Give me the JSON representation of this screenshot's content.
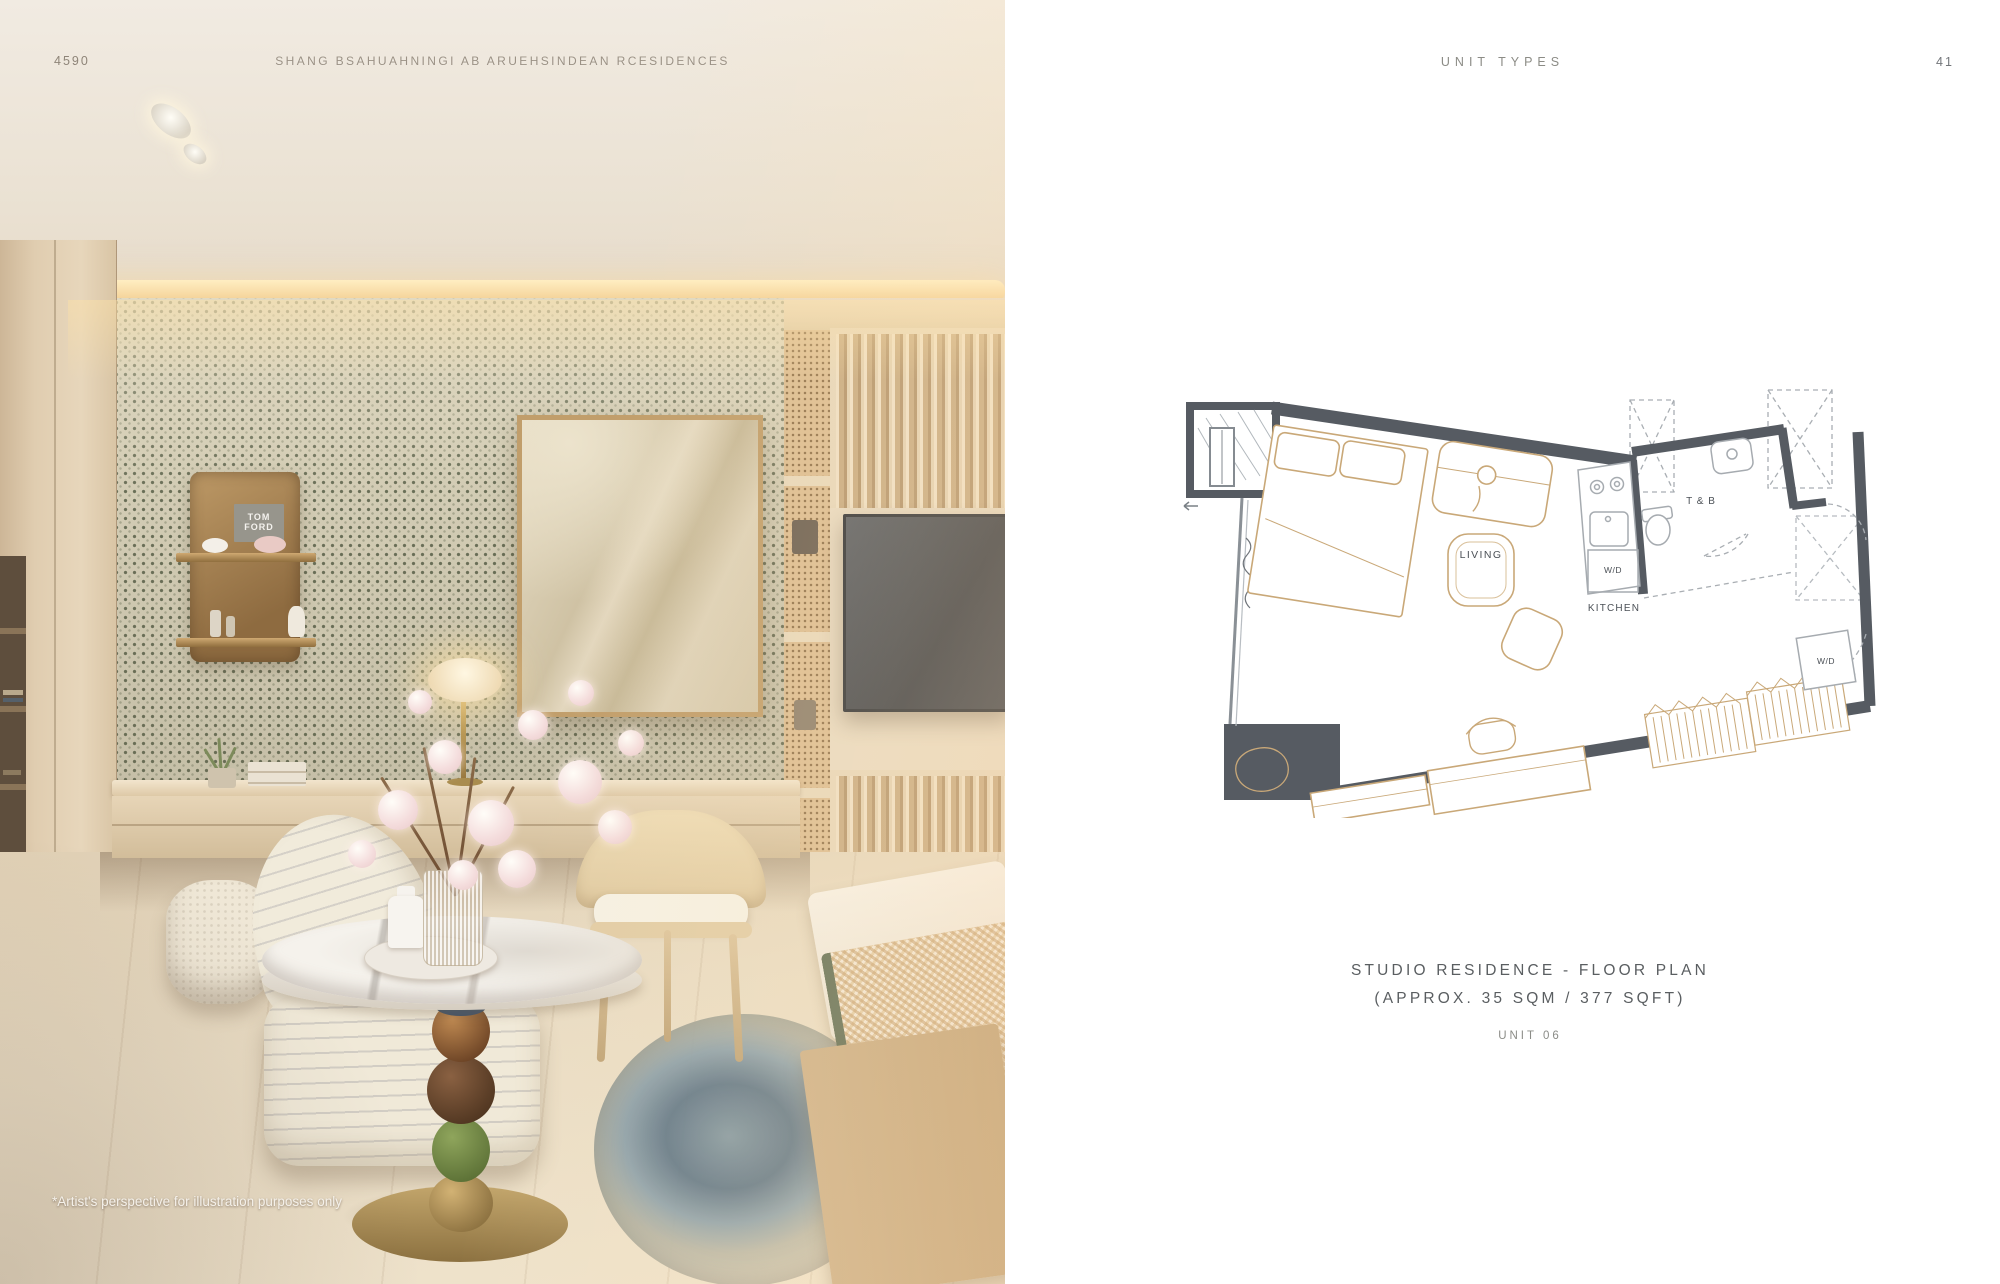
{
  "brochure": {
    "left_page": {
      "page_number": "4590",
      "header_title": "SHANG BSAHUAHNINGI AB ARUEHSINDEAN RCESIDENCES",
      "footnote": "*Artist's perspective for illustration purposes only",
      "shelf_brand": {
        "line1": "TOM",
        "line2": "FORD"
      }
    },
    "right_page": {
      "header": "UNIT TYPES",
      "page_number": "41",
      "floor_plan_labels": {
        "living": "LIVING",
        "kitchen": "KITCHEN",
        "toilet_bath": "T & B",
        "washer_dryer_kitchen": "W/D",
        "washer_dryer_closet": "W/D"
      },
      "caption": {
        "line1": "STUDIO RESIDENCE - FLOOR PLAN",
        "line2": "(APPROX. 35 SQM / 377 SQFT)",
        "unit": "UNIT 06"
      }
    },
    "colors": {
      "plan_wall": "#565b62",
      "plan_furniture": "#c9a878",
      "plan_fixture": "#a6abb0",
      "accent_brass": "#b2975f",
      "rug_teal": "#6f8795"
    }
  }
}
